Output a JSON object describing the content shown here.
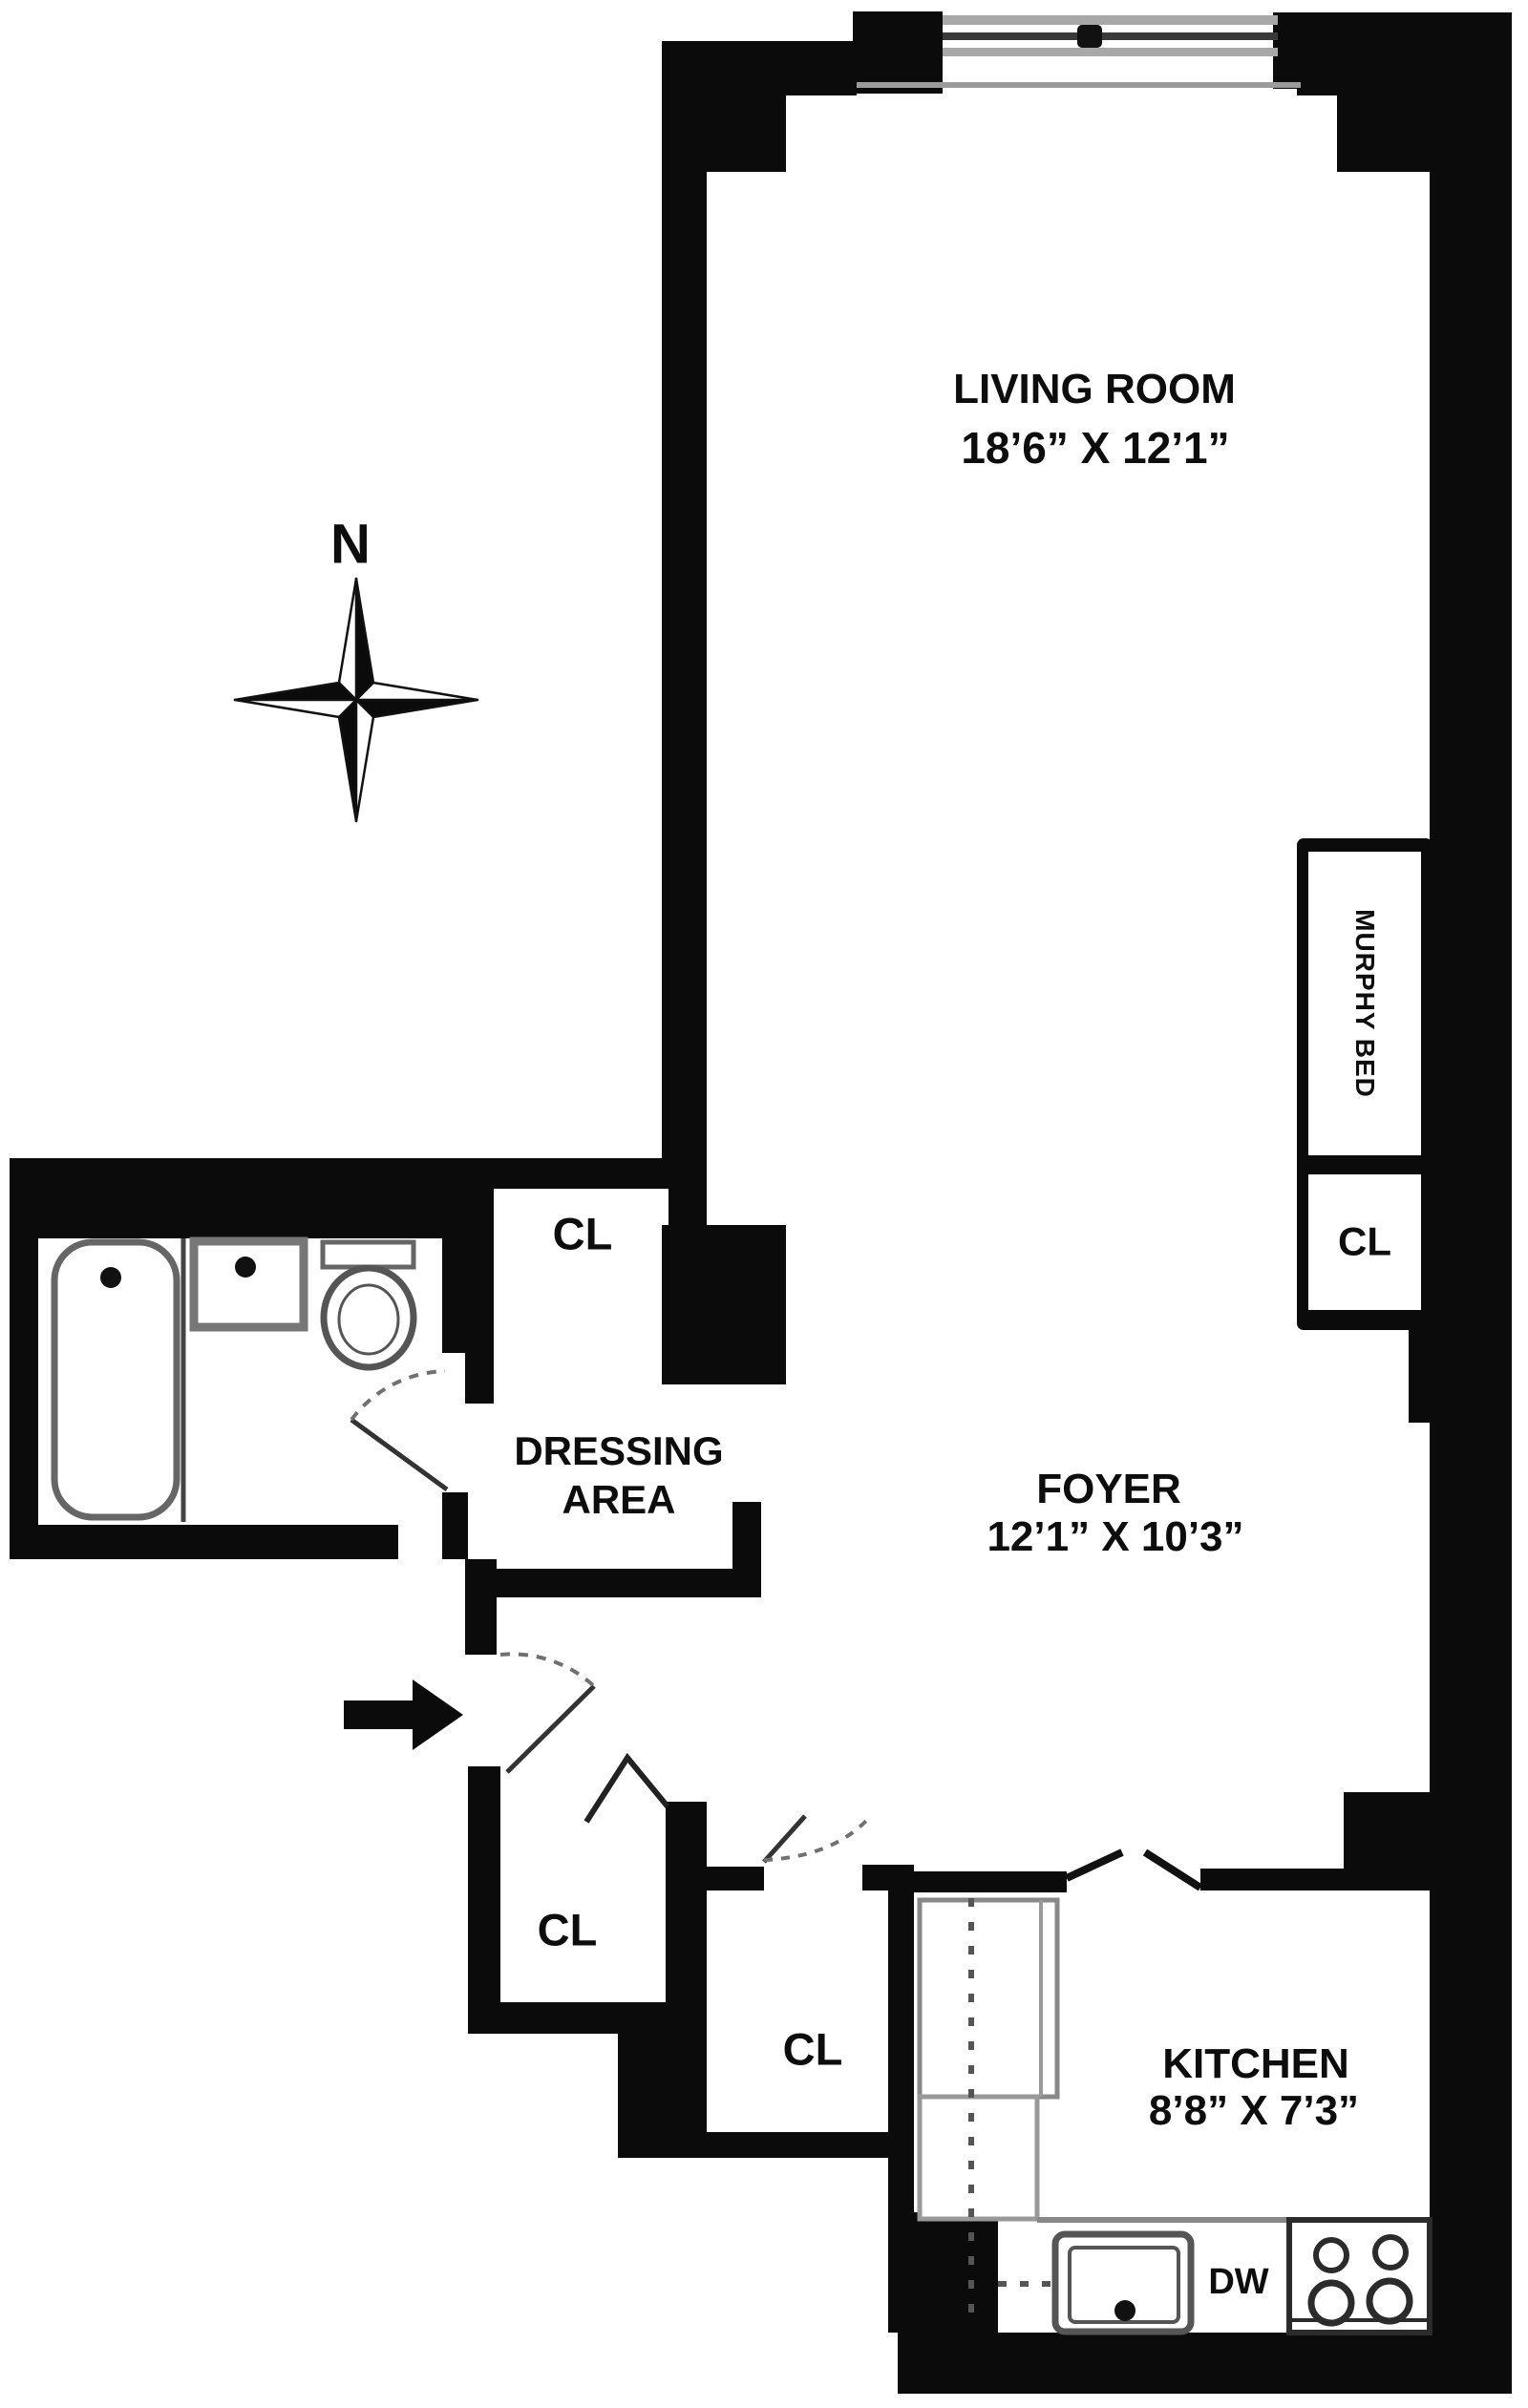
{
  "plan": {
    "compass": {
      "label": "N"
    },
    "rooms": {
      "living_room": {
        "name": "LIVING ROOM",
        "dims": "18’6” X 12’1”"
      },
      "foyer": {
        "name": "FOYER",
        "dims": "12’1” X 10’3”"
      },
      "kitchen": {
        "name": "KITCHEN",
        "dims": "8’8” X 7’3”"
      },
      "dressing_area": {
        "line1": "DRESSING",
        "line2": "AREA"
      }
    },
    "closets": {
      "dressing_cl": "CL",
      "entry_cl": "CL",
      "foyer_cl": "CL",
      "murphy_cl": "CL"
    },
    "features": {
      "murphy_bed": "MURPHY BED",
      "dishwasher": "DW"
    },
    "colors": {
      "wall": "#0b0b0b",
      "fixture_gray": "#777777",
      "door_arc_gray": "#707070",
      "background": "#ffffff"
    }
  }
}
